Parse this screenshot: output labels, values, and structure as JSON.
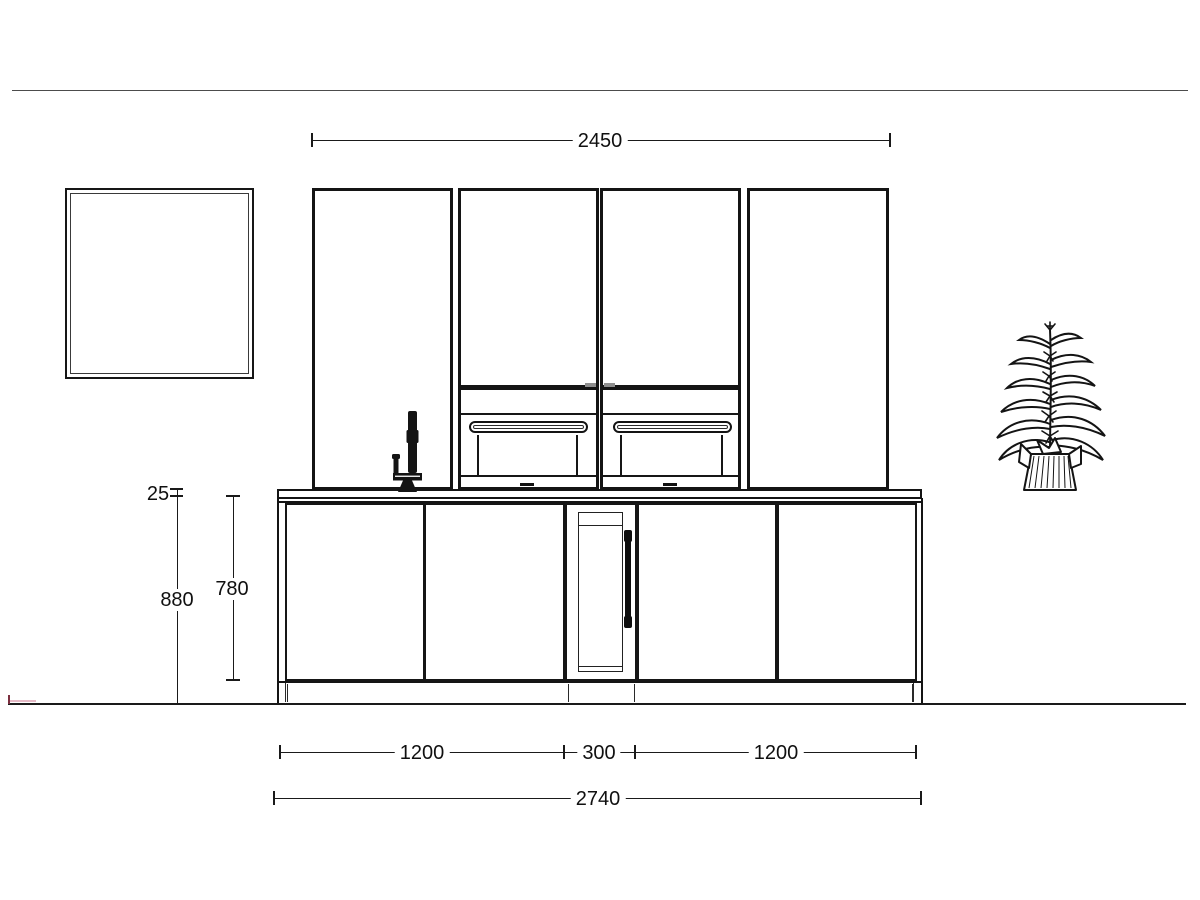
{
  "drawing": {
    "title": "kitchen-elevation-drawing",
    "dimensions": {
      "wall_run_width": "2450",
      "countertop_thickness": "25",
      "countertop_height": "880",
      "base_door_height": "780",
      "base_left_width": "1200",
      "base_center_width": "300",
      "base_right_width": "1200",
      "base_total_width": "2740"
    },
    "colors": {
      "line": "#1a1a1a",
      "wall_line": "#4c4c4c",
      "accent_mark_dark": "#7c2f3f",
      "accent_mark_light": "#e6bac6"
    }
  }
}
